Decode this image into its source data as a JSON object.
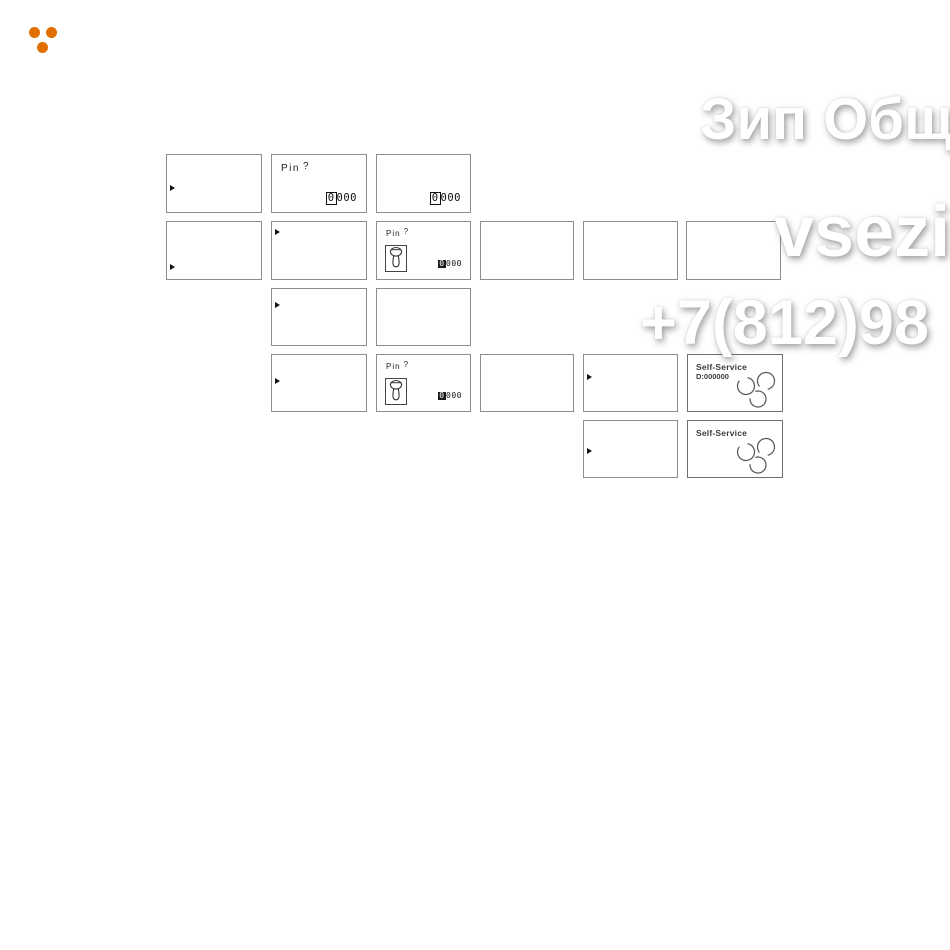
{
  "logo": {
    "name": "three-dots",
    "color": "#e06f00"
  },
  "watermark": {
    "color": "#ffffff",
    "lines": [
      {
        "text": "Зип Общ",
        "x": 700,
        "y": 91,
        "size": 58
      },
      {
        "text": "vsezip",
        "x": 774,
        "y": 196,
        "size": 72
      },
      {
        "text": "+7(812)98",
        "x": 640,
        "y": 292,
        "size": 63
      }
    ]
  },
  "screens": [
    {
      "name": "screen-1-1",
      "type": "arrow",
      "x": 166,
      "y": 154,
      "w": 96,
      "h": 59,
      "arrow_y": 30
    },
    {
      "name": "screen-1-2",
      "type": "pin",
      "x": 271,
      "y": 154,
      "w": 96,
      "h": 59,
      "label": "Pin",
      "q": "?",
      "cursor": "0",
      "code": "000"
    },
    {
      "name": "screen-1-3",
      "type": "code",
      "x": 376,
      "y": 154,
      "w": 95,
      "h": 59,
      "cursor": "0",
      "code": "000"
    },
    {
      "name": "screen-2-1",
      "type": "arrow",
      "x": 166,
      "y": 221,
      "w": 96,
      "h": 59,
      "arrow_y": 42
    },
    {
      "name": "screen-2-2",
      "type": "arrow",
      "x": 271,
      "y": 221,
      "w": 96,
      "h": 59,
      "arrow_y": 7
    },
    {
      "name": "screen-2-3",
      "type": "pinkey",
      "x": 376,
      "y": 221,
      "w": 95,
      "h": 59,
      "label": "Pin",
      "q": "?",
      "cursor": "0",
      "code": "000"
    },
    {
      "name": "screen-2-4",
      "type": "blank",
      "x": 480,
      "y": 221,
      "w": 94,
      "h": 59
    },
    {
      "name": "screen-2-5",
      "type": "blank",
      "x": 583,
      "y": 221,
      "w": 95,
      "h": 59
    },
    {
      "name": "screen-2-6",
      "type": "blank",
      "x": 686,
      "y": 221,
      "w": 95,
      "h": 59
    },
    {
      "name": "screen-3-1",
      "type": "arrow",
      "x": 271,
      "y": 288,
      "w": 96,
      "h": 58,
      "arrow_y": 13
    },
    {
      "name": "screen-3-2",
      "type": "blank",
      "x": 376,
      "y": 288,
      "w": 95,
      "h": 58
    },
    {
      "name": "screen-4-1",
      "type": "arrow",
      "x": 271,
      "y": 354,
      "w": 96,
      "h": 58,
      "arrow_y": 23
    },
    {
      "name": "screen-4-2",
      "type": "pinkey",
      "x": 376,
      "y": 354,
      "w": 95,
      "h": 58,
      "label": "Pin",
      "q": "?",
      "cursor": "0",
      "code": "000"
    },
    {
      "name": "screen-4-3",
      "type": "blank",
      "x": 480,
      "y": 354,
      "w": 94,
      "h": 58
    },
    {
      "name": "screen-4-4",
      "type": "arrow",
      "x": 583,
      "y": 354,
      "w": 95,
      "h": 58,
      "arrow_y": 19
    },
    {
      "name": "screen-4-5",
      "type": "selfservice",
      "x": 687,
      "y": 354,
      "w": 96,
      "h": 58,
      "title": "Self-Service",
      "sub": "D:000000"
    },
    {
      "name": "screen-5-1",
      "type": "arrow",
      "x": 583,
      "y": 420,
      "w": 95,
      "h": 58,
      "arrow_y": 27
    },
    {
      "name": "screen-5-2",
      "type": "selfservice",
      "x": 687,
      "y": 420,
      "w": 96,
      "h": 58,
      "title": "Self-Service",
      "sub": ""
    }
  ]
}
